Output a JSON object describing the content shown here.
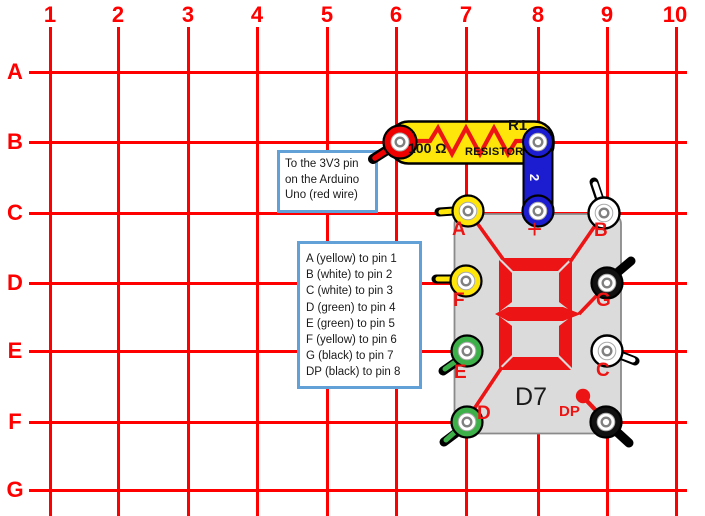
{
  "grid": {
    "columns": [
      "1",
      "2",
      "3",
      "4",
      "5",
      "6",
      "7",
      "8",
      "9",
      "10"
    ],
    "rows": [
      "A",
      "B",
      "C",
      "D",
      "E",
      "F",
      "G"
    ],
    "line_color": "#fe0000"
  },
  "notes": {
    "arduino": {
      "text": "To the 3V3 pin\non the Arduino\nUno (red wire)"
    },
    "pin_map": {
      "text": "A (yellow) to pin 1\nB (white) to pin 2\nC (white) to pin 3\nD (green) to pin 4\nE (green) to pin 5\nF (yellow) to pin 6\nG (black) to pin 7\nDP (black) to pin 8"
    }
  },
  "resistor": {
    "designator": "R1",
    "value": "100 Ω",
    "type_label": "RESISTOR",
    "body_color": "#ffe60a",
    "terminal_color": "#ee0000"
  },
  "wire": {
    "label": "2",
    "color": "#1c1cd1"
  },
  "display": {
    "designator": "D7",
    "segment_color": "#ec1414",
    "body_color": "#dbdbdb",
    "pins": [
      {
        "label": "A",
        "color": "yellow"
      },
      {
        "label": "+",
        "color": "blue"
      },
      {
        "label": "B",
        "color": "white"
      },
      {
        "label": "F",
        "color": "yellow"
      },
      {
        "label": "G",
        "color": "black"
      },
      {
        "label": "E",
        "color": "green"
      },
      {
        "label": "C",
        "color": "white"
      },
      {
        "label": "D",
        "color": "green"
      },
      {
        "label": "DP",
        "color": "black"
      }
    ]
  }
}
